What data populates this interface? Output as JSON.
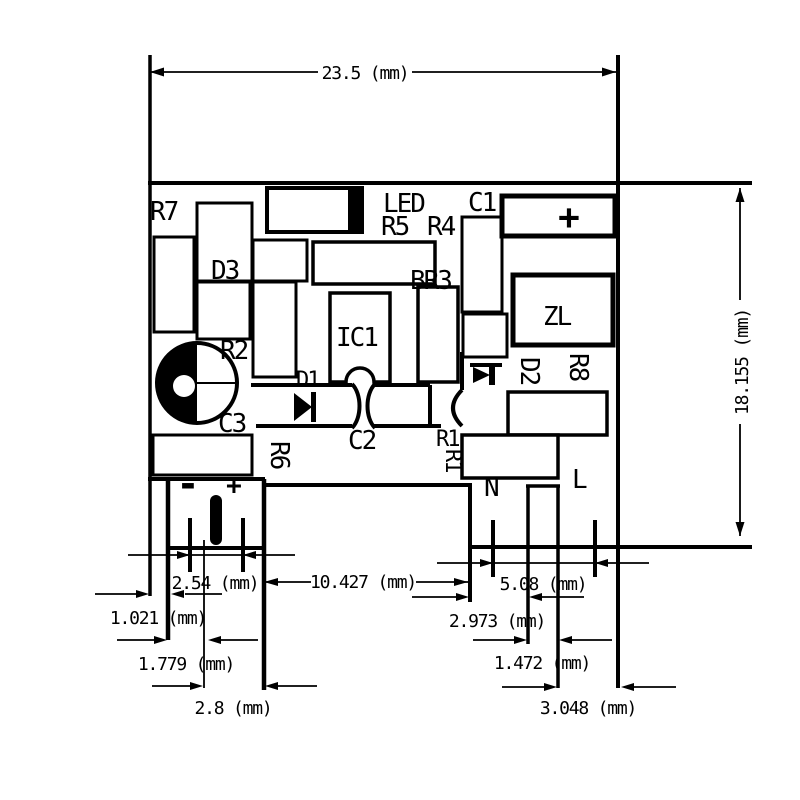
{
  "components": {
    "r7": "R7",
    "d3": "D3",
    "r2": "R2",
    "c3": "C3",
    "r6": "R6",
    "led": "LED",
    "r5": "R5",
    "r4": "R4",
    "br3": "BR3",
    "ic1": "IC1",
    "d1": "D1",
    "c2": "C2",
    "r1_top": "R1",
    "r1_side": "R1",
    "c1": "C1",
    "zl": "ZL",
    "d2": "D2",
    "r8": "R8"
  },
  "terminals": {
    "minus": "-",
    "plus": "+",
    "capacitor_plus": "+",
    "neutral": "N",
    "line": "L"
  },
  "dimensions": {
    "board_width": "23.5 (mm)",
    "board_height": "18.155 (mm)",
    "dc_pin_pitch": "2.54 (mm)",
    "edge_to_dc_block": "1.021 (mm)",
    "dc_block_to_pin_center": "1.779 (mm)",
    "dc_center_to_block_edge": "2.8 (mm)",
    "dc_block_to_ac_section": "10.427 (mm)",
    "ac_pin_pitch": "5.08 (mm)",
    "ac_section_to_slot": "2.973 (mm)",
    "slot_width": "1.472 (mm)",
    "slot_to_board_edge": "3.048 (mm)"
  }
}
